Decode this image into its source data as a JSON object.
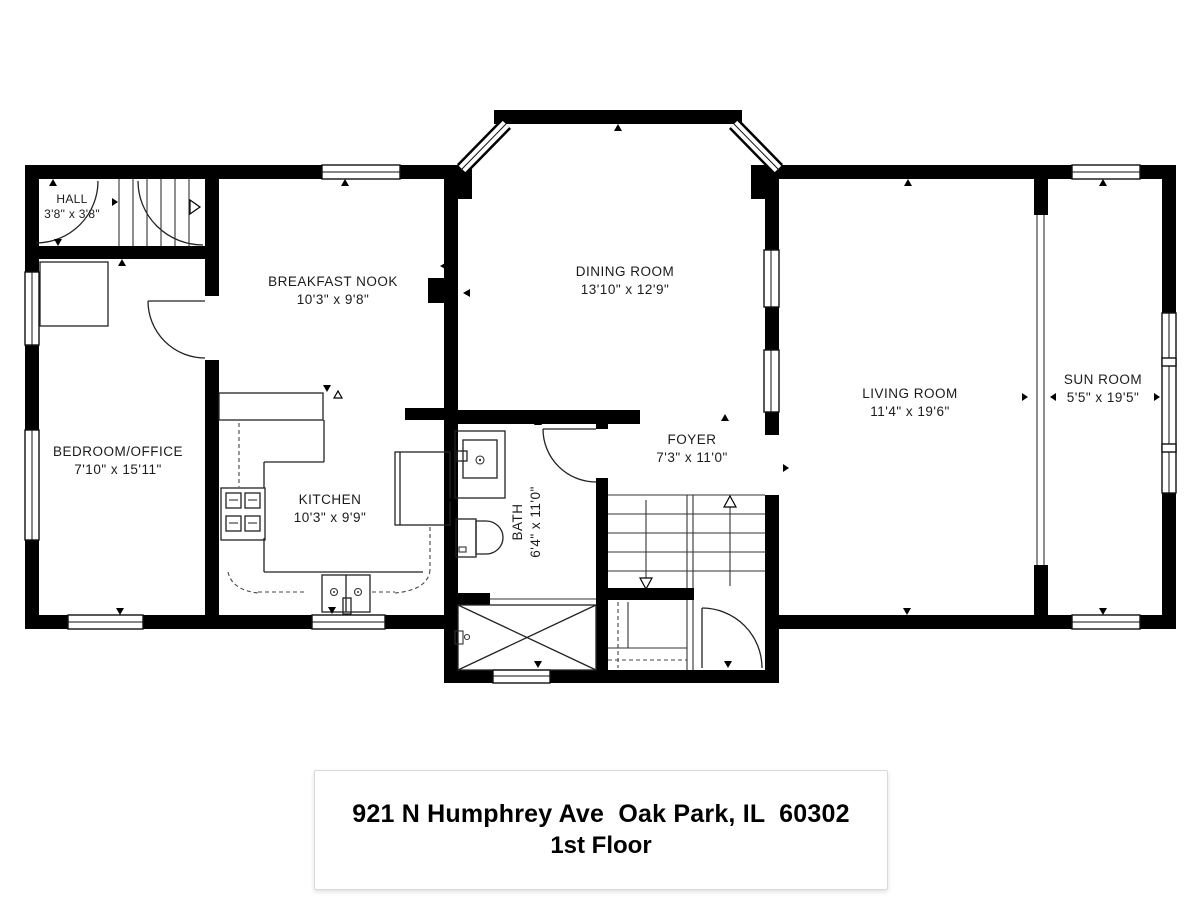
{
  "plan": {
    "rooms": [
      {
        "name": "HALL",
        "dims": "3'8\" x 3'8\""
      },
      {
        "name": "BREAKFAST NOOK",
        "dims": "10'3\" x 9'8\""
      },
      {
        "name": "DINING ROOM",
        "dims": "13'10\" x 12'9\""
      },
      {
        "name": "BEDROOM/OFFICE",
        "dims": "7'10\" x 15'11\""
      },
      {
        "name": "KITCHEN",
        "dims": "10'3\" x 9'9\""
      },
      {
        "name": "FOYER",
        "dims": "7'3\" x 11'0\""
      },
      {
        "name": "BATH",
        "dims": "6'4\" x 11'0\""
      },
      {
        "name": "LIVING ROOM",
        "dims": "11'4\" x 19'6\""
      },
      {
        "name": "SUN ROOM",
        "dims": "5'5\" x 19'5\""
      }
    ],
    "footer": {
      "address": "921 N Humphrey Ave  Oak Park, IL  60302",
      "floor": "1st Floor"
    },
    "colors": {
      "wall": "#000000",
      "background": "#ffffff",
      "line": "#222222"
    }
  }
}
